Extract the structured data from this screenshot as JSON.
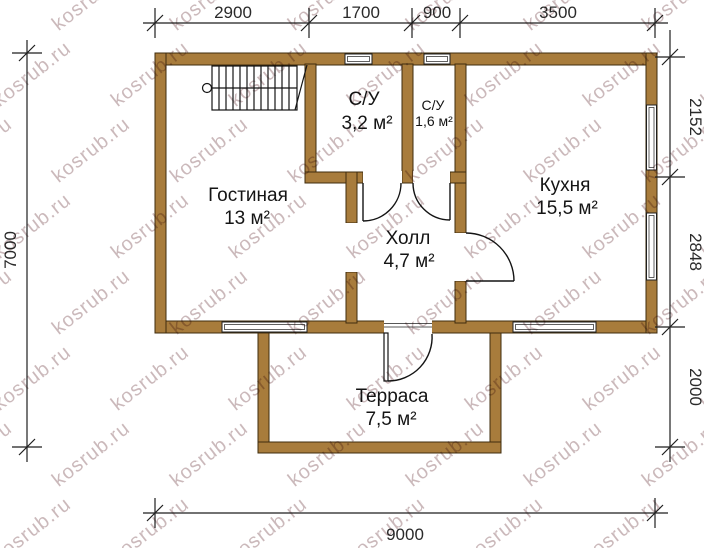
{
  "watermark": {
    "text": "kosrub.ru"
  },
  "colors": {
    "wall": "#a87c3c",
    "wall_outline": "#3f2c0e",
    "drawing_line": "#1f1f1f",
    "watermark": "rgba(140,100,105,0.45)"
  },
  "rooms": {
    "living": {
      "name": "Гостиная",
      "area": "13 м²"
    },
    "su_big": {
      "name": "С/У",
      "area": "3,2 м²"
    },
    "su_small": {
      "name": "С/У",
      "area": "1,6 м²"
    },
    "kitchen": {
      "name": "Кухня",
      "area": "15,5 м²"
    },
    "hall": {
      "name": "Холл",
      "area": "4,7 м²"
    },
    "terrace": {
      "name": "Терраса",
      "area": "7,5 м²"
    }
  },
  "dimensions": {
    "top": [
      "2900",
      "1700",
      "900",
      "3500"
    ],
    "right": [
      "2152",
      "2848",
      "2000"
    ],
    "left": [
      "7000"
    ],
    "bottom": [
      "9000"
    ]
  }
}
